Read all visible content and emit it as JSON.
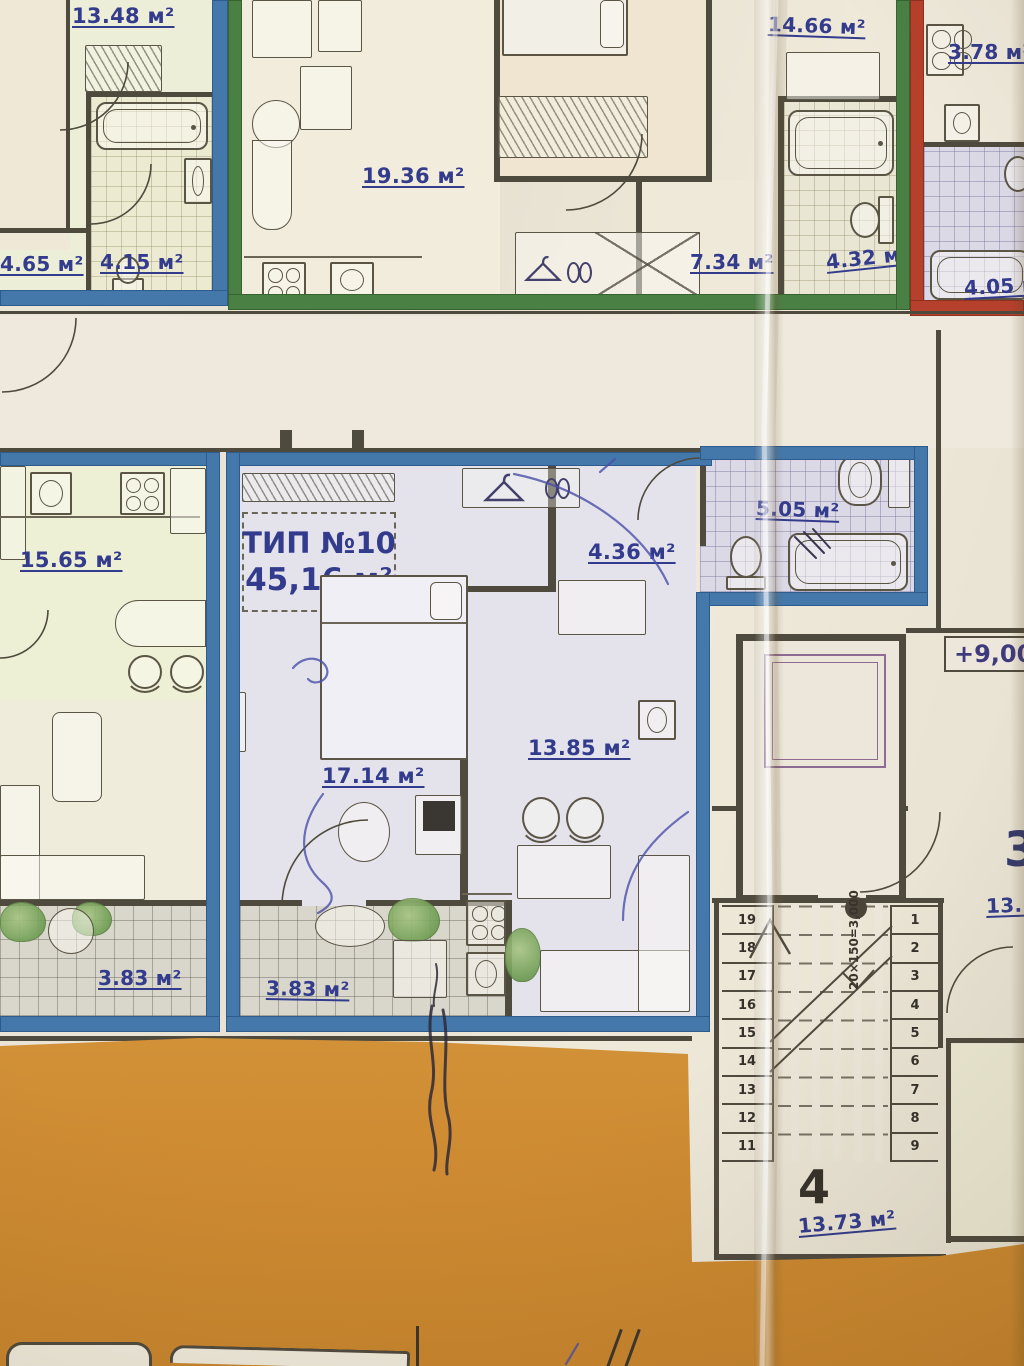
{
  "photo": {
    "kind": "folded printed apartment floor plan, photographed",
    "colors": {
      "paper": "#eae5d8",
      "accent_blue": "#4478ab",
      "accent_green": "#4a8044",
      "accent_red": "#b5402c",
      "label_ink": "#333b8c",
      "orange_band": "#cf8c33",
      "wall": "#4f4a3e",
      "elevator_purple": "#8d6b92"
    },
    "units": {
      "top_left": {
        "living": "13.48 м²",
        "hall": "4.65 м²",
        "bath": "4.15 м²"
      },
      "top_center": {
        "living": "19.36 м²",
        "bedroom": "14.66 м²",
        "hall": "7.34 м²",
        "bath": "4.32 м²"
      },
      "top_right": {
        "wc": "3.78 м²",
        "bath": "4.05 м²"
      },
      "mid_left": {
        "kitchen": "15.65 м²",
        "balcony": "3.83 м²"
      },
      "featured": {
        "type_title": "ТИП №10",
        "total_area": "45,16 м²",
        "bedroom": "17.14 м²",
        "living": "13.85 м²",
        "hall": "4.36 м²",
        "bath": "5.05 м²",
        "balcony": "3.83 м²"
      }
    },
    "common": {
      "elevation": "+9,000",
      "stair_formula": "20×150=3,000",
      "steps_left": [
        "19",
        "18",
        "17",
        "16",
        "15",
        "14",
        "13",
        "12",
        "11"
      ],
      "steps_right": [
        "1",
        "2",
        "3",
        "4",
        "5",
        "6",
        "7",
        "8",
        "9"
      ],
      "flight_no": "4",
      "stair_area": "13.73 м²",
      "adjacent_unit_no": "3",
      "adjacent_area": "13.50"
    }
  }
}
